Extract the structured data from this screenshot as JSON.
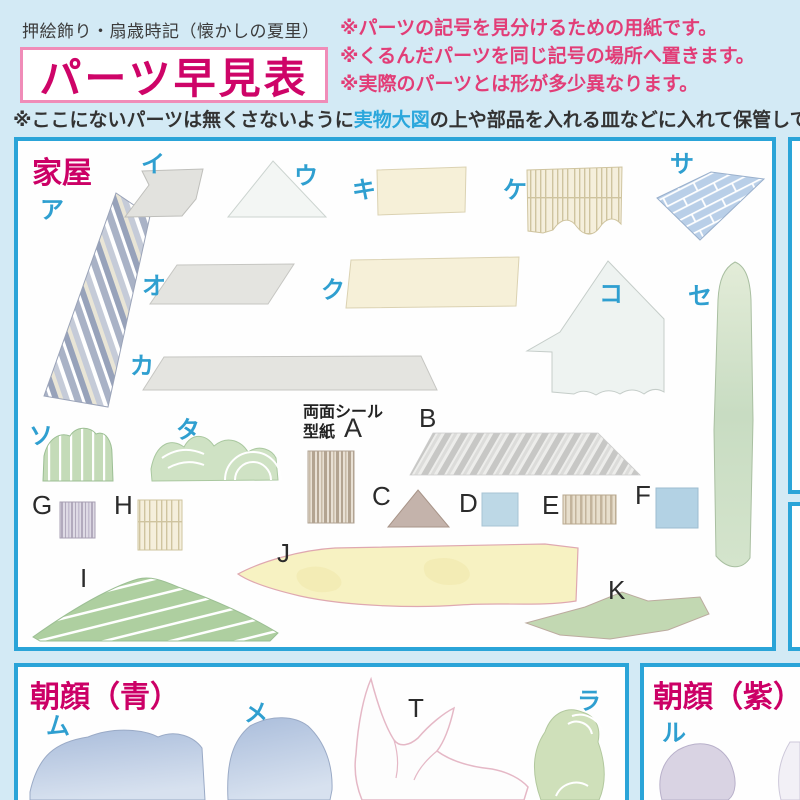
{
  "header": {
    "product_line": "押絵飾り・扇歳時記（懐かしの夏里）",
    "title": "パーツ早見表",
    "notes": [
      "※パーツの記号を見分けるための用紙です。",
      "※くるんだパーツを同じ記号の場所へ置きます。",
      "※実際のパーツとは形が多少異なります。"
    ],
    "storage_note": {
      "prefix": "※ここにないパーツは無くさないように",
      "highlight": "実物大図",
      "suffix": "の上や部品を入れる皿などに入れて保管しておきま"
    }
  },
  "panels": {
    "house": {
      "title": "家屋",
      "sticker_note_line1": "両面シール",
      "sticker_note_line2": "型紙",
      "parts": {
        "a": "ア",
        "i": "イ",
        "u": "ウ",
        "ki": "キ",
        "ke": "ケ",
        "sa": "サ",
        "o": "オ",
        "ku": "ク",
        "ko": "コ",
        "se": "セ",
        "ka": "カ",
        "so": "ソ",
        "ta": "タ",
        "A": "A",
        "B": "B",
        "C": "C",
        "D": "D",
        "E": "E",
        "F": "F",
        "G": "G",
        "H": "H",
        "I": "I",
        "J": "J",
        "K": "K"
      }
    },
    "asagao_blue": {
      "title": "朝顔（青）",
      "parts": {
        "mu": "ム",
        "me": "メ",
        "T": "T",
        "ra": "ラ"
      }
    },
    "asagao_purple": {
      "title": "朝顔（紫）",
      "parts": {
        "ru": "ル"
      }
    }
  },
  "colors": {
    "background": "#d3eaf5",
    "panel_border": "#2aa4d8",
    "accent_magenta": "#cc0066",
    "title_magenta": "#ce0468",
    "title_box_border": "#f08cb8",
    "note_pink": "#e23d77",
    "link_blue": "#2ba7dc",
    "label_blue": "#2f9fd0"
  }
}
